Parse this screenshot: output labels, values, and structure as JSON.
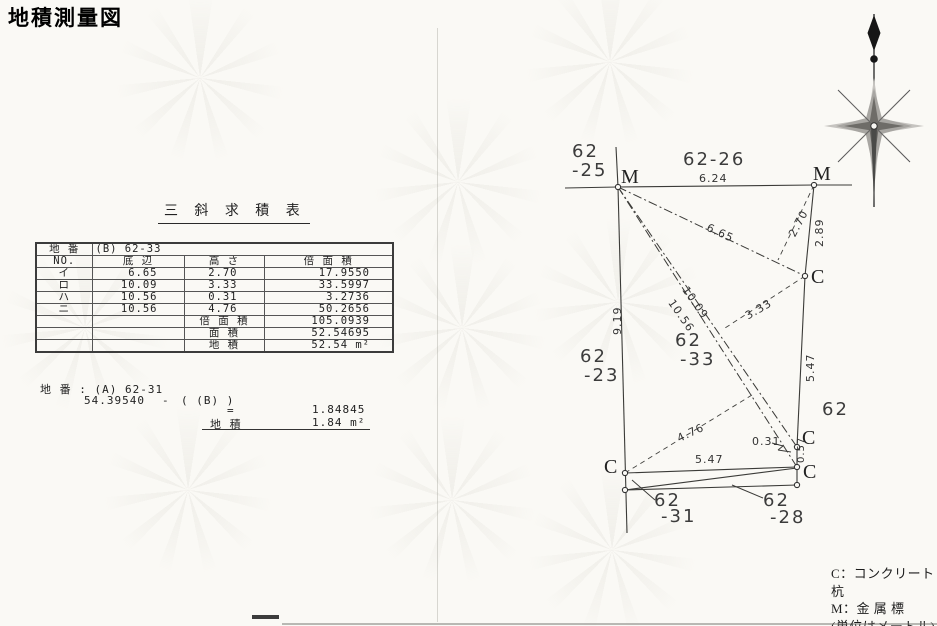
{
  "title": "地積測量図",
  "table": {
    "title": "三 斜 求 積 表",
    "parcel_label": "地 番",
    "parcel_value": "(B) 62-33",
    "headers": [
      "NO.",
      "底 辺",
      "高 さ",
      "倍 面 積"
    ],
    "rows": [
      {
        "no": "イ",
        "base": "6.65",
        "height": "2.70",
        "double_area": "17.9550"
      },
      {
        "no": "ロ",
        "base": "10.09",
        "height": "3.33",
        "double_area": "33.5997"
      },
      {
        "no": "ハ",
        "base": "10.56",
        "height": "0.31",
        "double_area": "3.2736"
      },
      {
        "no": "ニ",
        "base": "10.56",
        "height": "4.76",
        "double_area": "50.2656"
      }
    ],
    "summary": [
      {
        "label": "倍 面 積",
        "value": "105.0939"
      },
      {
        "label": "面 積",
        "value": "52.54695"
      },
      {
        "label": "地 積",
        "value": "52.54 m²"
      }
    ]
  },
  "calc": {
    "line1": "地 番 : (A) 62-31",
    "minuend": "54.39540",
    "minus": "-",
    "subtrahend": "( (B) )",
    "equals": "=",
    "result": "1.84845",
    "area_label": "地 積",
    "area_value": "1.84 m²"
  },
  "legend": {
    "c_line": "C：コンクリート杭",
    "m_line": "M：金 属 標",
    "unit_line": "(単位はメートル)"
  },
  "drawing": {
    "points": [
      {
        "name": "point-m-topleft",
        "x": 618,
        "y": 187
      },
      {
        "name": "point-m-topright",
        "x": 814,
        "y": 185
      },
      {
        "name": "point-c-right",
        "x": 805,
        "y": 276
      },
      {
        "name": "point-c-bottomright-upper",
        "x": 797,
        "y": 447
      },
      {
        "name": "point-c-bottomright-lower",
        "x": 797,
        "y": 467
      },
      {
        "name": "point-c-bottomleft",
        "x": 625,
        "y": 473
      },
      {
        "name": "point-bottomleft-lower",
        "x": 625,
        "y": 490
      },
      {
        "name": "point-bottomright-low",
        "x": 797,
        "y": 485
      }
    ],
    "lines": [
      {
        "name": "road-line-left",
        "x1": 565,
        "y1": 188,
        "x2": 618,
        "y2": 187,
        "style": "solid"
      },
      {
        "name": "boundary-top-6-24",
        "x1": 618,
        "y1": 187,
        "x2": 814,
        "y2": 185,
        "style": "solid"
      },
      {
        "name": "road-line-right",
        "x1": 814,
        "y1": 185,
        "x2": 852,
        "y2": 185,
        "style": "solid"
      },
      {
        "name": "boundary-left-spur",
        "x1": 616,
        "y1": 147,
        "x2": 618,
        "y2": 187,
        "style": "solid"
      },
      {
        "name": "boundary-left-9-19",
        "x1": 618,
        "y1": 187,
        "x2": 627,
        "y2": 533,
        "style": "solid"
      },
      {
        "name": "boundary-right-2-89",
        "x1": 814,
        "y1": 185,
        "x2": 805,
        "y2": 276,
        "style": "solid"
      },
      {
        "name": "boundary-right-5-47",
        "x1": 805,
        "y1": 276,
        "x2": 797,
        "y2": 447,
        "style": "solid"
      },
      {
        "name": "boundary-right-0-57",
        "x1": 797,
        "y1": 447,
        "x2": 797,
        "y2": 467,
        "style": "solid"
      },
      {
        "name": "boundary-right-lower",
        "x1": 797,
        "y1": 467,
        "x2": 797,
        "y2": 485,
        "style": "solid"
      },
      {
        "name": "boundary-bottom-5-47",
        "x1": 625,
        "y1": 473,
        "x2": 797,
        "y2": 467,
        "style": "solid"
      },
      {
        "name": "boundary-bottom-diagonal",
        "x1": 625,
        "y1": 490,
        "x2": 797,
        "y2": 468,
        "style": "solid"
      },
      {
        "name": "boundary-bottom-lower",
        "x1": 625,
        "y1": 490,
        "x2": 797,
        "y2": 485,
        "style": "solid"
      },
      {
        "name": "triangle-base-6-65",
        "x1": 618,
        "y1": 187,
        "x2": 805,
        "y2": 276,
        "style": "dashdot"
      },
      {
        "name": "triangle-base-10-09",
        "x1": 618,
        "y1": 187,
        "x2": 797,
        "y2": 447,
        "style": "dashdot"
      },
      {
        "name": "triangle-base-10-56",
        "x1": 618,
        "y1": 187,
        "x2": 797,
        "y2": 467,
        "style": "dashdot"
      },
      {
        "name": "height-2-70",
        "x1": 814,
        "y1": 185,
        "x2": 778,
        "y2": 260,
        "style": "dashed"
      },
      {
        "name": "height-3-33",
        "x1": 805,
        "y1": 276,
        "x2": 722,
        "y2": 330,
        "style": "dashed"
      },
      {
        "name": "height-4-76",
        "x1": 625,
        "y1": 473,
        "x2": 752,
        "y2": 395,
        "style": "dashed"
      },
      {
        "name": "leader-0-31-a",
        "x1": 772,
        "y1": 443,
        "x2": 783,
        "y2": 446,
        "style": "leader"
      },
      {
        "name": "leader-0-31-b",
        "x1": 783,
        "y1": 446,
        "x2": 778,
        "y2": 450,
        "style": "leader"
      },
      {
        "name": "leader-0-31-c",
        "x1": 778,
        "y1": 450,
        "x2": 791,
        "y2": 452,
        "style": "leader"
      },
      {
        "name": "leader-62-31",
        "x1": 632,
        "y1": 480,
        "x2": 655,
        "y2": 500,
        "style": "leader"
      },
      {
        "name": "leader-62-28",
        "x1": 732,
        "y1": 485,
        "x2": 763,
        "y2": 498,
        "style": "leader"
      }
    ],
    "labels": [
      {
        "name": "parcel-62-25-line1",
        "text": "62",
        "x": 572,
        "y": 141,
        "size": 18,
        "cls": "parcel"
      },
      {
        "name": "parcel-62-25-line2",
        "text": "-25",
        "x": 572,
        "y": 160,
        "size": 18,
        "cls": "parcel"
      },
      {
        "name": "parcel-62-26",
        "text": "62-26",
        "x": 683,
        "y": 149,
        "size": 18,
        "cls": "parcel"
      },
      {
        "name": "dim-6-24",
        "text": "6.24",
        "x": 699,
        "y": 172,
        "size": 11,
        "cls": "dim"
      },
      {
        "name": "marker-label-m-left",
        "text": "M",
        "x": 621,
        "y": 166,
        "size": 20,
        "cls": "marker"
      },
      {
        "name": "marker-label-m-right",
        "text": "M",
        "x": 813,
        "y": 163,
        "size": 20,
        "cls": "marker"
      },
      {
        "name": "dim-6-65",
        "text": "6.65",
        "x": 710,
        "y": 221,
        "size": 11,
        "cls": "dim",
        "rot": 25
      },
      {
        "name": "dim-2-70",
        "text": "2.70",
        "x": 786,
        "y": 233,
        "size": 11,
        "cls": "dim",
        "rot": -62
      },
      {
        "name": "dim-2-89",
        "text": "2.89",
        "x": 813,
        "y": 247,
        "size": 11,
        "cls": "dim",
        "rot": -90
      },
      {
        "name": "marker-label-c-right",
        "text": "C",
        "x": 811,
        "y": 266,
        "size": 20,
        "cls": "marker"
      },
      {
        "name": "dim-9-19",
        "text": "9.19",
        "x": 611,
        "y": 335,
        "size": 11,
        "cls": "dim",
        "rot": -90
      },
      {
        "name": "parcel-62-23-line1",
        "text": "62",
        "x": 580,
        "y": 346,
        "size": 18,
        "cls": "parcel"
      },
      {
        "name": "parcel-62-23-line2",
        "text": "-23",
        "x": 584,
        "y": 365,
        "size": 18,
        "cls": "parcel"
      },
      {
        "name": "parcel-62-33-line1",
        "text": "62",
        "x": 675,
        "y": 330,
        "size": 18,
        "cls": "parcel"
      },
      {
        "name": "parcel-62-33-line2",
        "text": "-33",
        "x": 680,
        "y": 349,
        "size": 18,
        "cls": "parcel"
      },
      {
        "name": "dim-10-09",
        "text": "10.09",
        "x": 690,
        "y": 284,
        "size": 11,
        "cls": "dim",
        "rot": 55
      },
      {
        "name": "dim-10-56",
        "text": "10.56",
        "x": 676,
        "y": 297,
        "size": 11,
        "cls": "dim",
        "rot": 55
      },
      {
        "name": "dim-3-33",
        "text": "3.33",
        "x": 743,
        "y": 311,
        "size": 11,
        "cls": "dim",
        "rot": -30
      },
      {
        "name": "dim-5-47-right",
        "text": "5.47",
        "x": 804,
        "y": 382,
        "size": 11,
        "cls": "dim",
        "rot": -90
      },
      {
        "name": "parcel-62-right",
        "text": "62",
        "x": 822,
        "y": 399,
        "size": 18,
        "cls": "parcel"
      },
      {
        "name": "dim-4-76",
        "text": "4.76",
        "x": 675,
        "y": 433,
        "size": 11,
        "cls": "dim",
        "rot": -25
      },
      {
        "name": "dim-0-31",
        "text": "0.31",
        "x": 752,
        "y": 435,
        "size": 11,
        "cls": "dim"
      },
      {
        "name": "marker-label-c-bottomright-upper",
        "text": "C",
        "x": 802,
        "y": 427,
        "size": 20,
        "cls": "marker"
      },
      {
        "name": "dim-0-57",
        "text": "0.57",
        "x": 796,
        "y": 463,
        "size": 10,
        "cls": "dim",
        "rot": -90
      },
      {
        "name": "marker-label-c-bottomright-lower",
        "text": "C",
        "x": 803,
        "y": 461,
        "size": 20,
        "cls": "marker"
      },
      {
        "name": "marker-label-c-bottomleft",
        "text": "C",
        "x": 604,
        "y": 456,
        "size": 20,
        "cls": "marker"
      },
      {
        "name": "dim-5-47-bottom",
        "text": "5.47",
        "x": 695,
        "y": 453,
        "size": 11,
        "cls": "dim"
      },
      {
        "name": "parcel-62-31-line1",
        "text": "62",
        "x": 654,
        "y": 490,
        "size": 18,
        "cls": "parcel"
      },
      {
        "name": "parcel-62-31-line2",
        "text": "-31",
        "x": 661,
        "y": 506,
        "size": 18,
        "cls": "parcel"
      },
      {
        "name": "parcel-62-28-line1",
        "text": "62",
        "x": 763,
        "y": 490,
        "size": 18,
        "cls": "parcel"
      },
      {
        "name": "parcel-62-28-line2",
        "text": "-28",
        "x": 770,
        "y": 507,
        "size": 18,
        "cls": "parcel"
      }
    ]
  }
}
